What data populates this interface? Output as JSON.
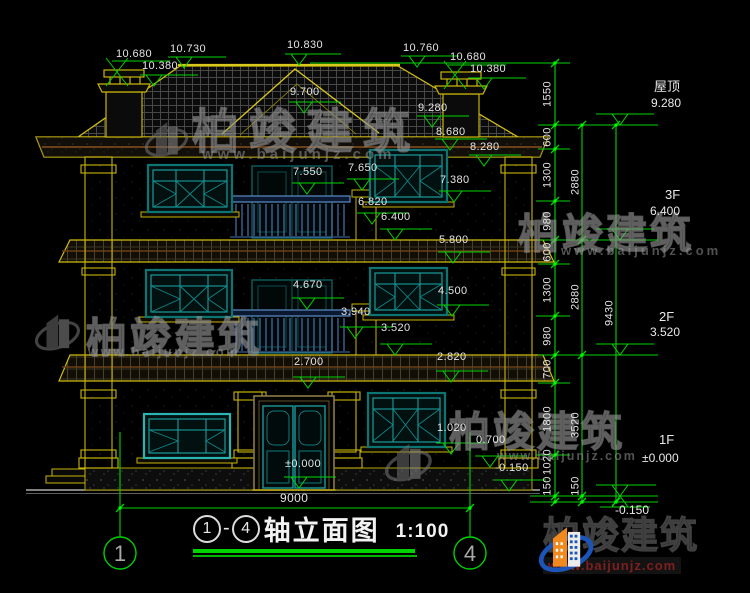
{
  "colors": {
    "green": "#00d400",
    "yellow": "#c9b509",
    "teal": "#16a0a0",
    "rail_blue": "#4a7ab8",
    "logo_blue": "#1c54b8",
    "logo_orange": "#f08a1e",
    "url_red": "#7e1f1f",
    "text": "#e4e4e4"
  },
  "title": {
    "axis_start": "1",
    "axis_end": "4",
    "dash": "-",
    "name": "轴立面图",
    "scale": "1:100"
  },
  "axes": {
    "left": "1",
    "right": "4"
  },
  "levels": [
    {
      "label": "屋顶",
      "elev": "9.280"
    },
    {
      "label": "3F",
      "elev": "6.400"
    },
    {
      "label": "2F",
      "elev": "3.520"
    },
    {
      "label": "1F",
      "elev": "±0.000"
    },
    {
      "label": "",
      "elev": "-0.150"
    }
  ],
  "watermark": {
    "brand": "柏竣建筑",
    "url": "www.baijunjz.com"
  },
  "logo": {
    "brand": "柏竣建筑",
    "url": "www.baijunjz.com"
  },
  "labels": [
    {
      "g": "top-dim",
      "t": "10.680",
      "x": 116,
      "y": 49
    },
    {
      "g": "top-dim",
      "t": "10.730",
      "x": 170,
      "y": 44
    },
    {
      "g": "top-dim",
      "t": "10.830",
      "x": 287,
      "y": 40
    },
    {
      "g": "top-dim",
      "t": "10.760",
      "x": 403,
      "y": 43
    },
    {
      "g": "top-dim",
      "t": "10.680",
      "x": 450,
      "y": 52
    },
    {
      "g": "top-dim",
      "t": "10.380",
      "x": 142,
      "y": 61
    },
    {
      "g": "top-dim",
      "t": "10.380",
      "x": 470,
      "y": 64
    },
    {
      "g": "elev-label",
      "t": "9.700",
      "x": 290,
      "y": 87
    },
    {
      "g": "elev-label",
      "t": "9.280",
      "x": 418,
      "y": 103
    },
    {
      "g": "elev-label",
      "t": "8.680",
      "x": 436,
      "y": 127
    },
    {
      "g": "elev-label",
      "t": "8.280",
      "x": 470,
      "y": 142
    },
    {
      "g": "elev-label",
      "t": "7.550",
      "x": 293,
      "y": 167
    },
    {
      "g": "elev-label",
      "t": "7.650",
      "x": 348,
      "y": 163
    },
    {
      "g": "elev-label",
      "t": "7.380",
      "x": 440,
      "y": 175
    },
    {
      "g": "elev-label",
      "t": "6.820",
      "x": 358,
      "y": 197
    },
    {
      "g": "elev-label",
      "t": "6.400",
      "x": 381,
      "y": 212
    },
    {
      "g": "elev-label",
      "t": "5.800",
      "x": 439,
      "y": 235
    },
    {
      "g": "elev-label",
      "t": "4.670",
      "x": 293,
      "y": 280
    },
    {
      "g": "elev-label",
      "t": "4.500",
      "x": 438,
      "y": 286
    },
    {
      "g": "elev-label",
      "t": "3.940",
      "x": 341,
      "y": 307
    },
    {
      "g": "elev-label",
      "t": "3.520",
      "x": 381,
      "y": 323
    },
    {
      "g": "elev-label",
      "t": "2.700",
      "x": 294,
      "y": 357
    },
    {
      "g": "elev-label",
      "t": "2.820",
      "x": 437,
      "y": 352
    },
    {
      "g": "elev-label",
      "t": "1.020",
      "x": 437,
      "y": 423
    },
    {
      "g": "elev-label",
      "t": "0.700",
      "x": 476,
      "y": 435
    },
    {
      "g": "elev-label",
      "t": "-0.150",
      "x": 495,
      "y": 463
    },
    {
      "g": "elev-label",
      "t": "±0.000",
      "x": 285,
      "y": 459
    },
    {
      "g": "width-dim",
      "t": "9000",
      "x": 280,
      "y": 492,
      "s": 12
    },
    {
      "g": "chain-inner-dim",
      "t": "1550",
      "x": 548,
      "y": 94,
      "r": 1
    },
    {
      "g": "chain-inner-dim",
      "t": "600",
      "x": 548,
      "y": 137,
      "r": 1
    },
    {
      "g": "chain-inner-dim",
      "t": "1300",
      "x": 548,
      "y": 175,
      "r": 1
    },
    {
      "g": "chain-inner-dim",
      "t": "980",
      "x": 548,
      "y": 221,
      "r": 1
    },
    {
      "g": "chain-inner-dim",
      "t": "600",
      "x": 548,
      "y": 252,
      "r": 1
    },
    {
      "g": "chain-inner-dim",
      "t": "1300",
      "x": 548,
      "y": 290,
      "r": 1
    },
    {
      "g": "chain-inner-dim",
      "t": "980",
      "x": 548,
      "y": 336,
      "r": 1
    },
    {
      "g": "chain-inner-dim",
      "t": "700",
      "x": 548,
      "y": 369,
      "r": 1
    },
    {
      "g": "chain-inner-dim",
      "t": "1800",
      "x": 548,
      "y": 419,
      "r": 1
    },
    {
      "g": "chain-inner-dim",
      "t": "1020",
      "x": 548,
      "y": 462,
      "r": 1
    },
    {
      "g": "chain-inner-dim",
      "t": "150",
      "x": 548,
      "y": 486,
      "r": 1
    },
    {
      "g": "chain-mid-dim",
      "t": "2880",
      "x": 576,
      "y": 182,
      "r": 1
    },
    {
      "g": "chain-mid-dim",
      "t": "2880",
      "x": 576,
      "y": 297,
      "r": 1
    },
    {
      "g": "chain-mid-dim",
      "t": "3520",
      "x": 576,
      "y": 425,
      "r": 1
    },
    {
      "g": "chain-mid-dim",
      "t": "150",
      "x": 576,
      "y": 486,
      "r": 1
    },
    {
      "g": "chain-outer-dim",
      "t": "9430",
      "x": 610,
      "y": 313,
      "r": 1
    }
  ]
}
